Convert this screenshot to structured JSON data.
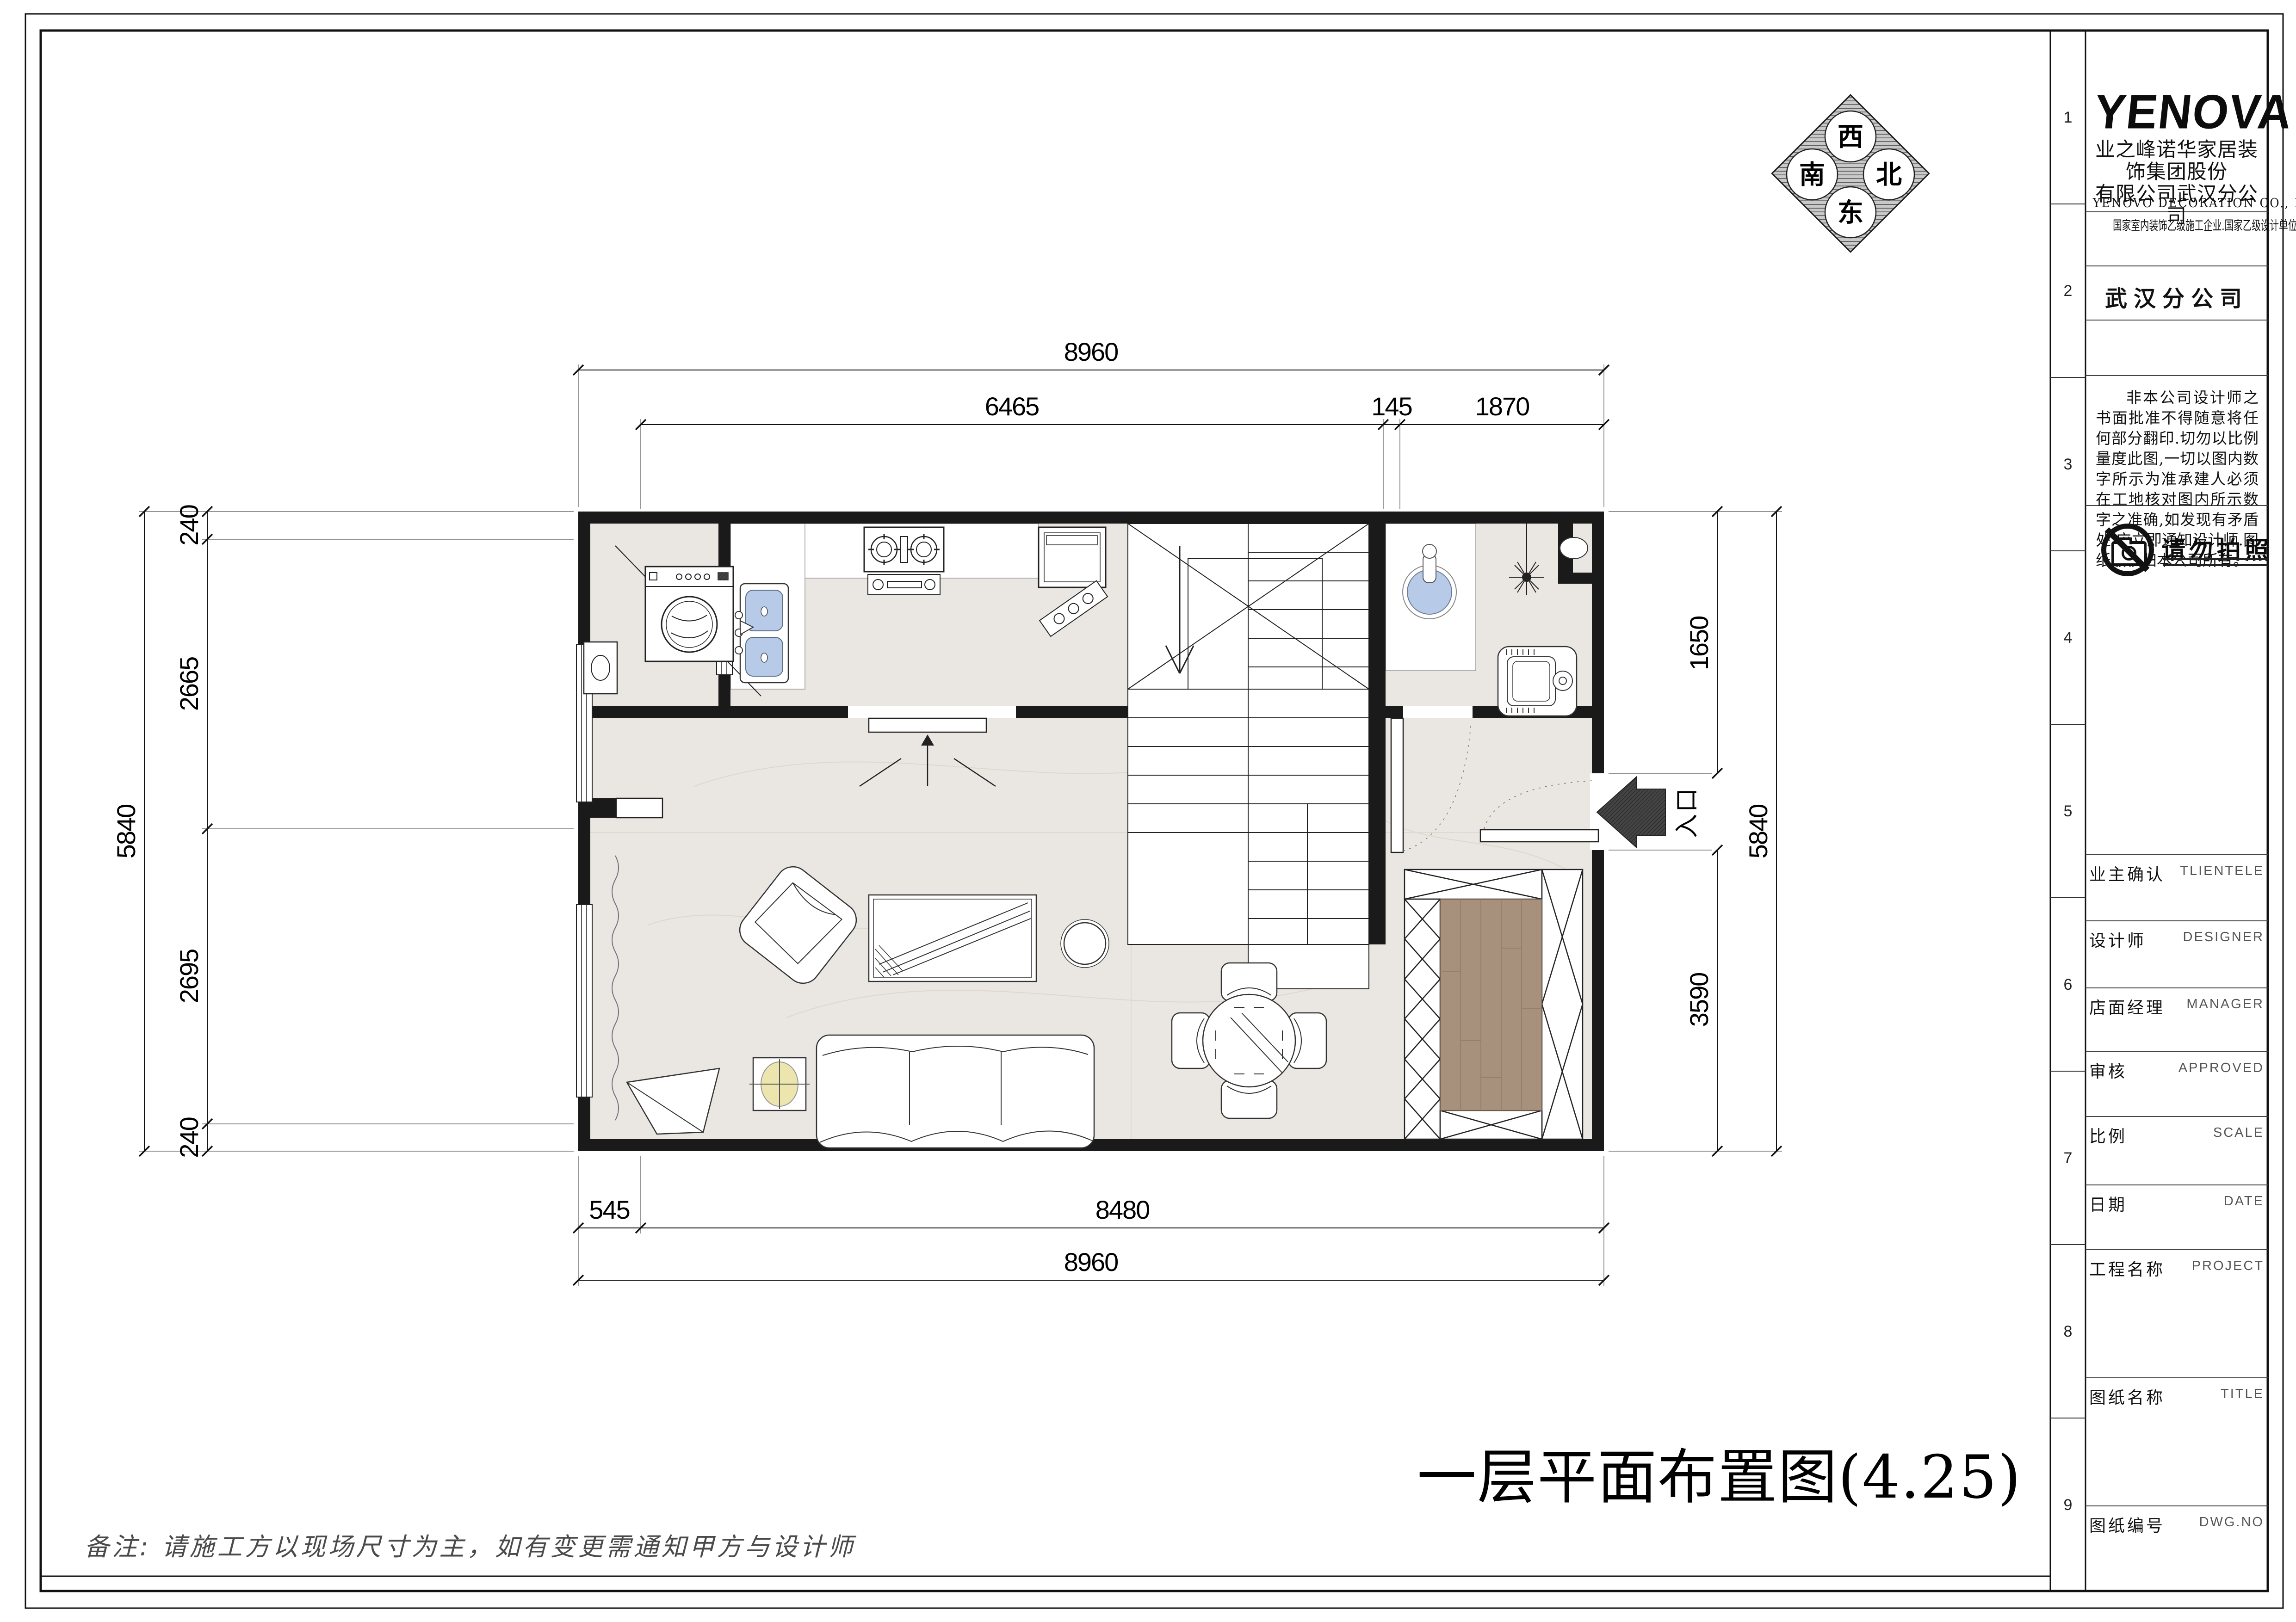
{
  "title_block": {
    "logo": "YENOVA",
    "company_cn_line1": "业之峰诺华家居装饰集团股份",
    "company_cn_line2": "有限公司武汉分公司",
    "company_en": "YENOVO  DECORATION  CO.,  LTD",
    "qualification": "国家室内装饰乙级施工企业.国家乙级设计单位",
    "branch": "武汉分公司",
    "disclaimer": "非本公司设计师之书面批准不得随意将任何部分翻印.切勿以比例量度此图,一切以图内数字所示为准承建人必须在工地核对图内所示数字之准确,如发现有矛盾处,应立即通知设计师.图纸版权归本公司所有。",
    "no_photo_label": "请勿拍照",
    "fields": [
      {
        "cn": "业主确认",
        "en": "TLIENTELE"
      },
      {
        "cn": "设计师",
        "en": "DESIGNER"
      },
      {
        "cn": "店面经理",
        "en": "MANAGER"
      },
      {
        "cn": "审核",
        "en": "APPROVED"
      },
      {
        "cn": "比例",
        "en": "SCALE"
      },
      {
        "cn": "日期",
        "en": "DATE"
      },
      {
        "cn": "工程名称",
        "en": "PROJECT"
      },
      {
        "cn": "图纸名称",
        "en": "TITLE"
      },
      {
        "cn": "图纸编号",
        "en": "DWG.NO"
      }
    ],
    "row_numbers": [
      "1",
      "2",
      "3",
      "4",
      "5",
      "6",
      "7",
      "8",
      "9"
    ]
  },
  "compass": {
    "top": "西",
    "left": "南",
    "right": "北",
    "bottom": "东"
  },
  "plan": {
    "drawing_title": "一层平面布置图(4.25)",
    "note": "备注: 请施工方以现场尺寸为主，如有变更需通知甲方与设计师",
    "entrance_label": "入口"
  },
  "dimensions": {
    "top_overall": "8960",
    "top_segments": [
      "6465",
      "145",
      "1870"
    ],
    "left_overall": "5840",
    "left_segments": [
      "240",
      "2665",
      "2695",
      "240"
    ],
    "right_segments": [
      "1650",
      "3590"
    ],
    "right_overall": "5840",
    "bottom_segments": [
      "545",
      "8480"
    ],
    "bottom_overall": "8960"
  },
  "icons": {
    "compass": "direction-compass",
    "no_photo": "no-camera-icon",
    "entrance": "entrance-arrow-icon"
  },
  "colors": {
    "wall": "#1a1a1a",
    "floor": "#eae6e1",
    "fixture_blue": "#b7cbe9",
    "wood": "#a8917c",
    "plant_yellow": "#ece6ae",
    "arrow_dark": "#3a3a3a"
  }
}
